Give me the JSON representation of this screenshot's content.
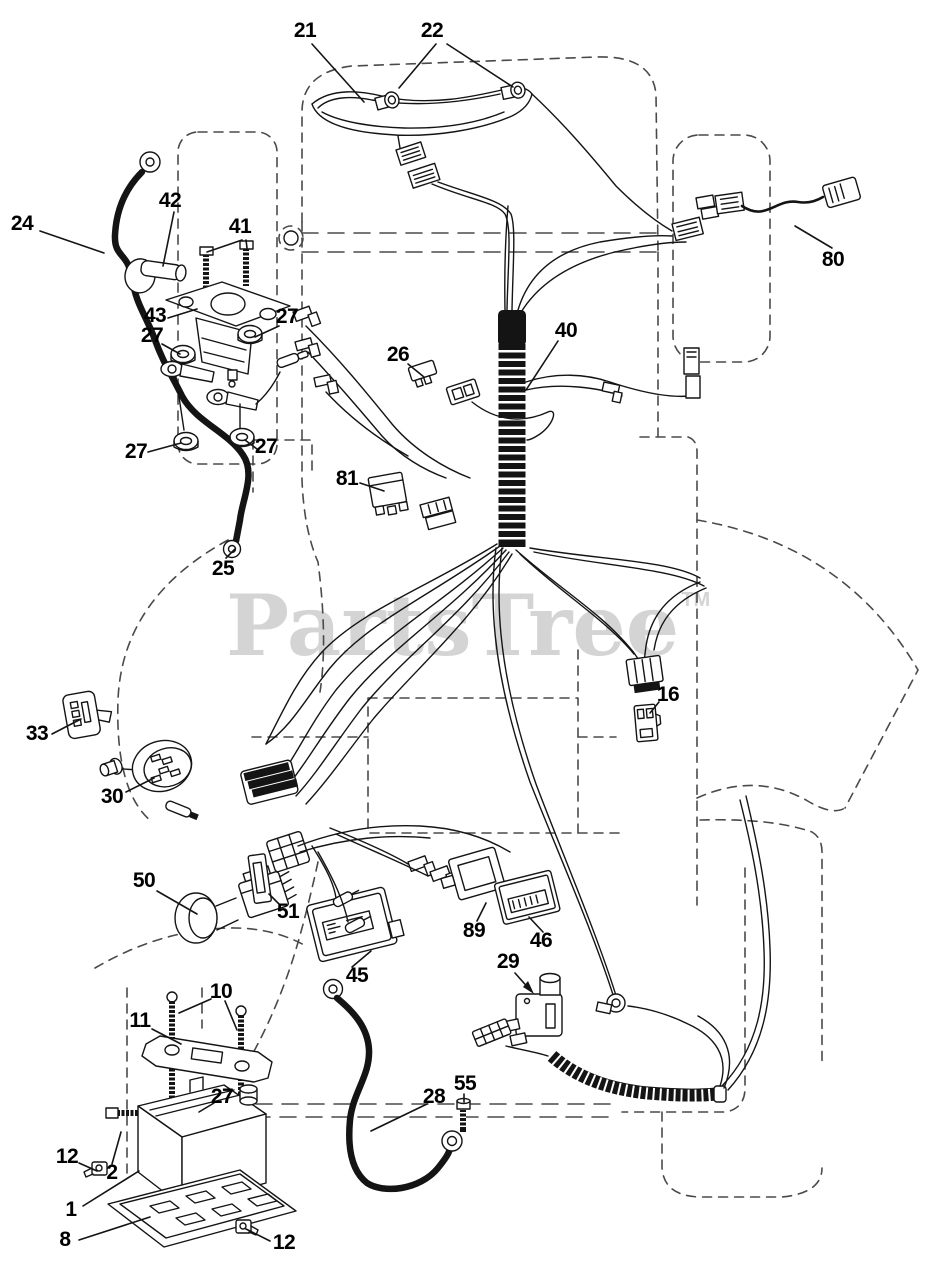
{
  "watermark": {
    "text": "PartsTree",
    "tm": "TM"
  },
  "colors": {
    "line": "#141414",
    "dashed": "#4a4a4a",
    "watermark": "#d4d4d4",
    "label": "#000000",
    "background": "#ffffff"
  },
  "callouts": [
    {
      "label": "21",
      "x": 305,
      "y": 31
    },
    {
      "label": "22",
      "x": 432,
      "y": 31
    },
    {
      "label": "24",
      "x": 22,
      "y": 224
    },
    {
      "label": "42",
      "x": 170,
      "y": 201
    },
    {
      "label": "41",
      "x": 240,
      "y": 227
    },
    {
      "label": "43",
      "x": 155,
      "y": 316
    },
    {
      "label": "27",
      "x": 287,
      "y": 317
    },
    {
      "label": "27",
      "x": 152,
      "y": 336
    },
    {
      "label": "27",
      "x": 136,
      "y": 452
    },
    {
      "label": "27",
      "x": 266,
      "y": 447
    },
    {
      "label": "26",
      "x": 398,
      "y": 355
    },
    {
      "label": "40",
      "x": 566,
      "y": 331
    },
    {
      "label": "80",
      "x": 833,
      "y": 260
    },
    {
      "label": "81",
      "x": 347,
      "y": 479
    },
    {
      "label": "25",
      "x": 223,
      "y": 569
    },
    {
      "label": "33",
      "x": 37,
      "y": 734
    },
    {
      "label": "30",
      "x": 112,
      "y": 797
    },
    {
      "label": "16",
      "x": 668,
      "y": 695
    },
    {
      "label": "50",
      "x": 144,
      "y": 881
    },
    {
      "label": "51",
      "x": 288,
      "y": 912
    },
    {
      "label": "45",
      "x": 357,
      "y": 976
    },
    {
      "label": "89",
      "x": 474,
      "y": 931
    },
    {
      "label": "46",
      "x": 541,
      "y": 941
    },
    {
      "label": "29",
      "x": 508,
      "y": 962
    },
    {
      "label": "10",
      "x": 221,
      "y": 992
    },
    {
      "label": "11",
      "x": 140,
      "y": 1021
    },
    {
      "label": "27",
      "x": 222,
      "y": 1097
    },
    {
      "label": "28",
      "x": 434,
      "y": 1097
    },
    {
      "label": "55",
      "x": 465,
      "y": 1084
    },
    {
      "label": "12",
      "x": 67,
      "y": 1157
    },
    {
      "label": "2",
      "x": 112,
      "y": 1173
    },
    {
      "label": "1",
      "x": 71,
      "y": 1210
    },
    {
      "label": "8",
      "x": 65,
      "y": 1240
    },
    {
      "label": "12",
      "x": 284,
      "y": 1243
    }
  ]
}
